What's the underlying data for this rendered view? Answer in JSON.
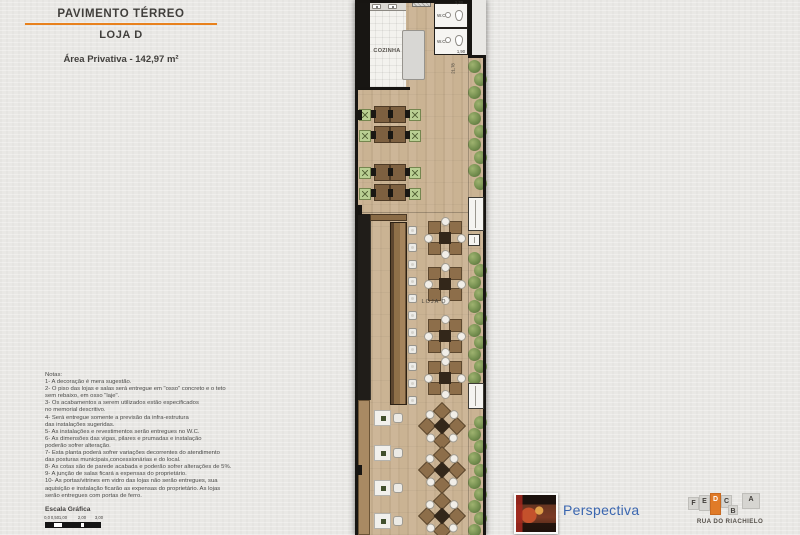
{
  "header": {
    "title": "PAVIMENTO TÉRREO",
    "subtitle": "LOJA D",
    "area_label": "Área Privativa - 142,97 m²"
  },
  "plan": {
    "kitchen_label": "COZINHA",
    "wc_label_1": "W.C.",
    "wc_label_2": "W.C.",
    "store_label": "LOJA D",
    "dim_top": "1,30",
    "dim_mid": "1,90",
    "dim_side": "21,78"
  },
  "notes": {
    "lines": [
      "Notas:",
      "1- A decoração é mera sugestão.",
      "2- O piso das lojas e salas será entregue em \"osso\" concreto e o teto",
      "sem rebaixo, em osso  \"laje\".",
      "3- Os acabamentos a serem utilizados estão especificados",
      "no memorial descritivo.",
      "4- Será entregue somente a previsão da infra-estrutura",
      "das instalações sugeridas.",
      "5- As instalações e revestimentos serão entregues no W.C.",
      "6- As dimensões das vigas, pilares e prumadas e instalação",
      "poderão sofrer alteração.",
      "7- Esta planta poderá sofrer variações decorrentes do atendimento",
      "das posturas municipais,concessionárias e do local.",
      "8- As cotas são de parede acabada e poderão sofrer alterações de 5%.",
      "9- A junção de salas ficará a expensas do proprietário.",
      "10- As portas/vitrines em vidro das lojas não serão entregues, sua",
      "aquisição e instalação ficarão as expensas do proprietário. As lojas",
      "serão entregues com portas de ferro."
    ]
  },
  "scale_bar": {
    "title": "Escala Gráfica",
    "ticks": [
      "0,0",
      "0,50",
      "1,00",
      "2,00",
      "3,00"
    ]
  },
  "perspective": {
    "label": "Perspectiva"
  },
  "logo": {
    "letters": [
      "F",
      "E",
      "D",
      "C",
      "B",
      "A"
    ],
    "highlight_letter": "D",
    "name": "RUA DO RIACHIELO"
  },
  "colors": {
    "accent_orange": "#e8811c",
    "perspective_blue": "#3a66b0",
    "logo_highlight": "#e07b28"
  }
}
